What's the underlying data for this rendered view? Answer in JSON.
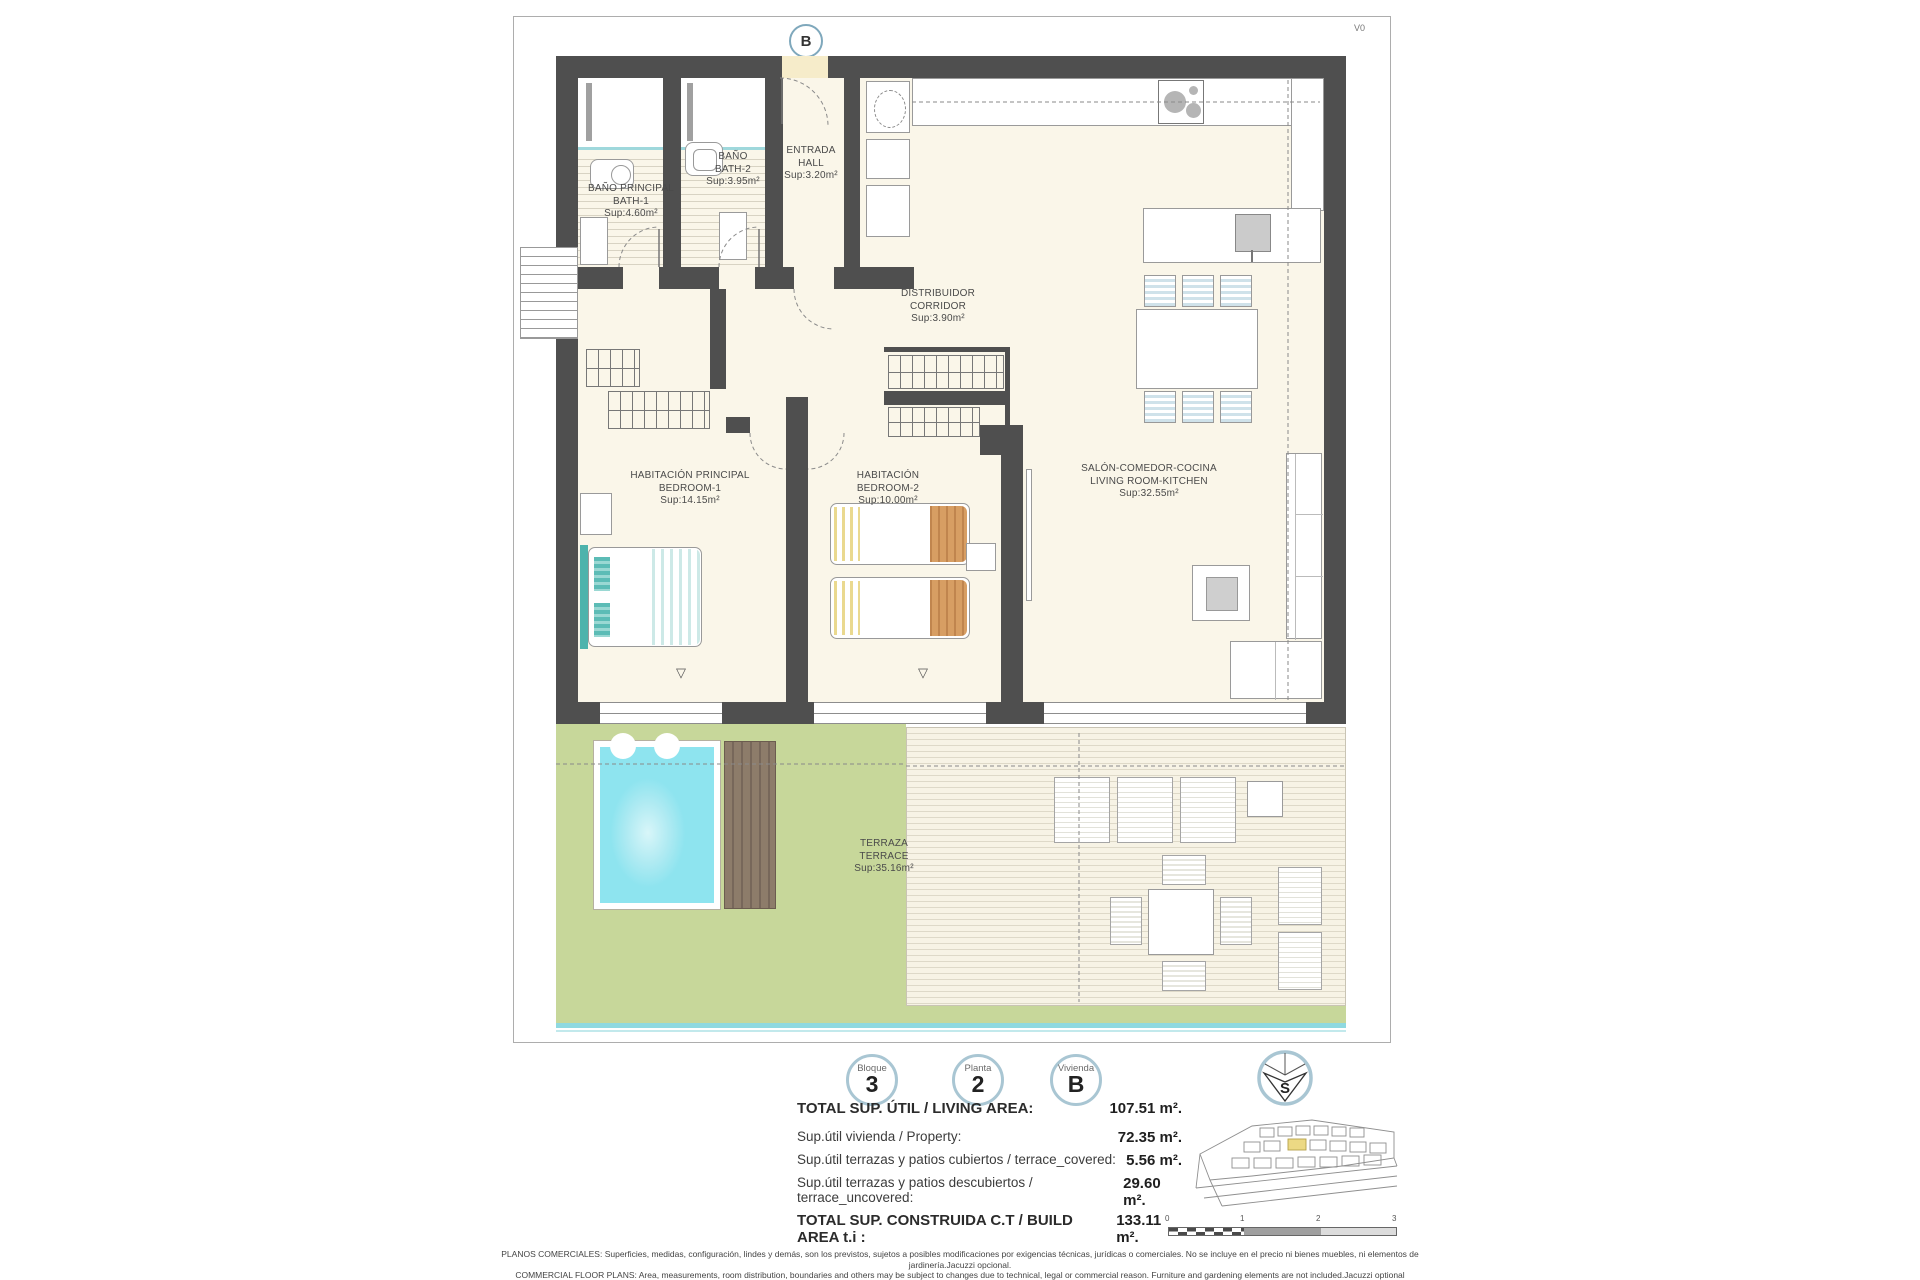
{
  "page": {
    "version_label": "V0",
    "section_marker": "B"
  },
  "plan": {
    "window_marker": "▽",
    "rooms": [
      {
        "id": "bath-1",
        "line1": "BAÑO PRINCIPAL",
        "line2": "BATH-1",
        "line3": "Sup:4.60m²"
      },
      {
        "id": "bath-2",
        "line1": "BAÑO",
        "line2": "BATH-2",
        "line3": "Sup:3.95m²"
      },
      {
        "id": "hall",
        "line1": "ENTRADA",
        "line2": "HALL",
        "line3": "Sup:3.20m²"
      },
      {
        "id": "corridor",
        "line1": "DISTRIBUIDOR",
        "line2": "CORRIDOR",
        "line3": "Sup:3.90m²"
      },
      {
        "id": "bedroom-1",
        "line1": "HABITACIÓN PRINCIPAL",
        "line2": "BEDROOM-1",
        "line3": "Sup:14.15m²"
      },
      {
        "id": "bedroom-2",
        "line1": "HABITACIÓN",
        "line2": "BEDROOM-2",
        "line3": "Sup:10.00m²"
      },
      {
        "id": "living",
        "line1": "SALÓN-COMEDOR-COCINA",
        "line2": "LIVING ROOM-KITCHEN",
        "line3": "Sup:32.55m²"
      },
      {
        "id": "terrace",
        "line1": "TERRAZA",
        "line2": "TERRACE",
        "line3": "Sup:35.16m²"
      }
    ]
  },
  "footer": {
    "badges": [
      {
        "label": "Bloque",
        "value": "3"
      },
      {
        "label": "Planta",
        "value": "2"
      },
      {
        "label": "Vivienda",
        "value": "B"
      }
    ],
    "compass_letter": "S",
    "area_table": {
      "rows": [
        {
          "label": "TOTAL SUP. ÚTIL / LIVING AREA:",
          "value": "107.51 m²."
        },
        {
          "label": "Sup.útil vivienda / Property:",
          "value": "72.35 m²."
        },
        {
          "label": "Sup.útil terrazas y patios cubiertos / terrace_covered:",
          "value": "5.56 m²."
        },
        {
          "label": "Sup.útil terrazas y patios descubiertos / terrace_uncovered:",
          "value": "29.60 m²."
        },
        {
          "label": "TOTAL SUP. CONSTRUIDA C.T / BUILD AREA t.i :",
          "value": "133.11 m²."
        }
      ]
    },
    "scale_ticks": [
      "0",
      "1",
      "2",
      "3"
    ],
    "disclaimer_line1": "PLANOS COMERCIALES: Superficies, medidas, configuración, lindes y demás, son los previstos, sujetos a posibles modificaciones por exigencias técnicas, jurídicas o comerciales. No se incluye en el precio ni bienes muebles, ni elementos de jardinería.Jacuzzi opcional.",
    "disclaimer_line2": "COMMERCIAL FLOOR PLANS: Area, measurements, room distribution, boundaries and others may be subject to changes due to technical, legal or commercial reason. Furniture and gardening elements are not included.Jacuzzi optional"
  },
  "colors": {
    "wall": "#4f4f4f",
    "floor": "#faf6e9",
    "lawn": "#c7d79a",
    "pool": "#8ee4ef",
    "aqua": "#8fd9e0",
    "deck": "#8d7c6a",
    "accentTeal": "#4db3ac",
    "accentOrange": "#d79e63",
    "accentYellow": "#ead98f",
    "ring": "#a9c6d3",
    "highlight": "#ecd984",
    "mat": "#f6ecca"
  }
}
